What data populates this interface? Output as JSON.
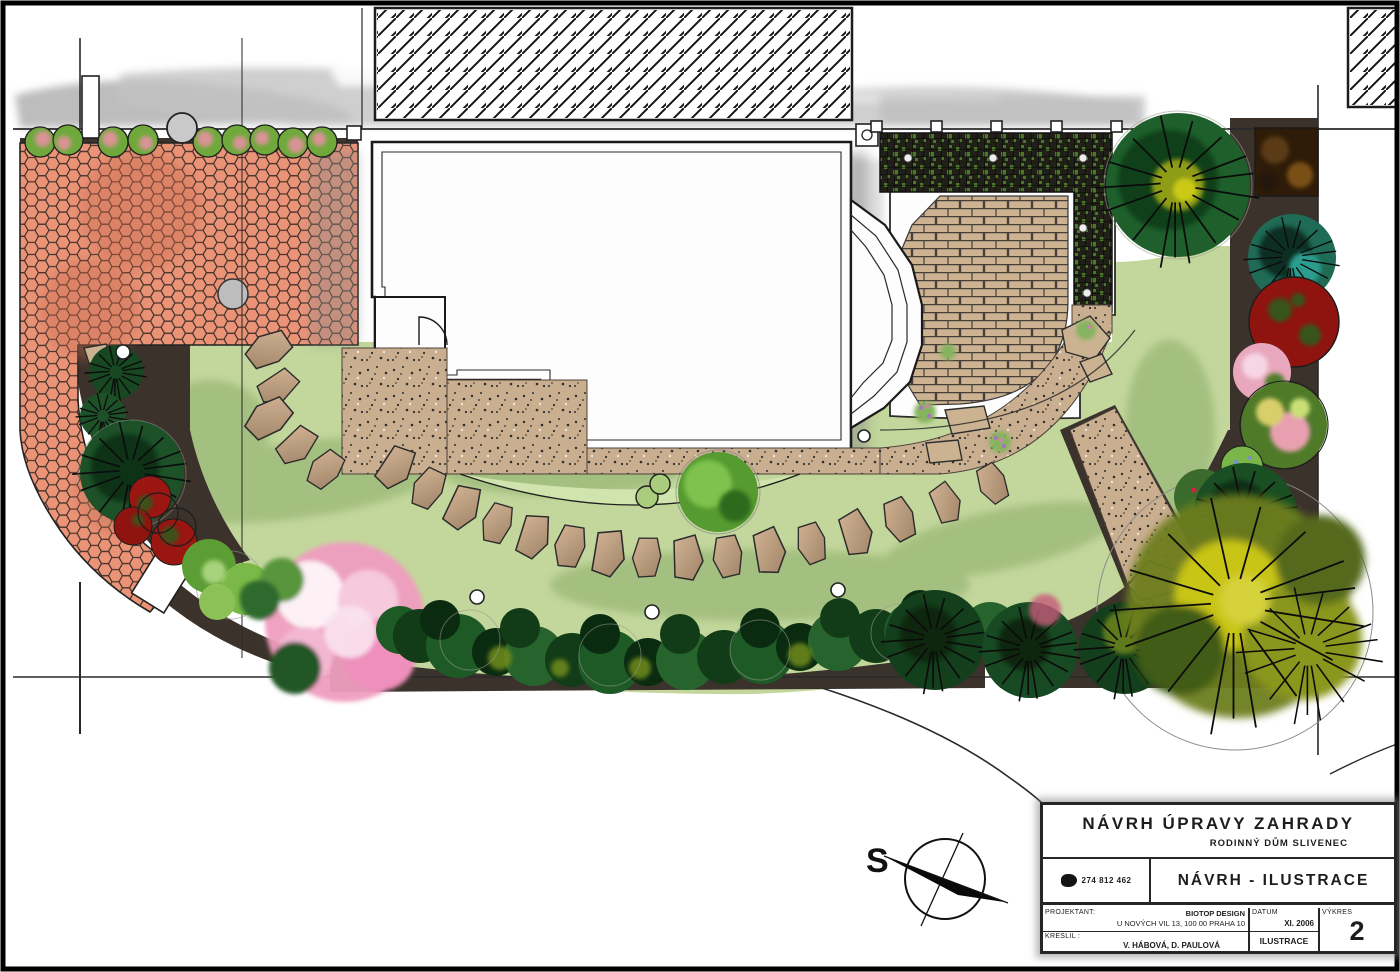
{
  "compass": {
    "label": "S"
  },
  "title_block": {
    "title": "NÁVRH ÚPRAVY ZAHRADY",
    "subtitle": "RODINNÝ DŮM SLIVENEC",
    "logo_phone": "274 812 462",
    "drawing_name": "NÁVRH - ILUSTRACE",
    "projektant_label": "PROJEKTANT:",
    "projektant_firm": "BIOTOP DESIGN",
    "projektant_address": "U NOVÝCH VIL 13, 100 00 PRAHA 10",
    "kreslil_label": "KRESLIL :",
    "kreslil_value": "V. HÁBOVÁ, D. PAULOVÁ",
    "datum_label": "DATUM",
    "datum_value": "XI. 2006",
    "category_value": "ILUSTRACE",
    "vykres_label": "VÝKRES",
    "vykres_value": "2"
  },
  "colors": {
    "lawn": "#c3d79c",
    "lawn_light": "#d2e4ad",
    "lawn_shadow": "#9ab877",
    "paving_salmon": "#ea9377",
    "gravel": "#c7ac8e",
    "pavers": "#cdb292",
    "bed_dark": "#3a322b",
    "hedge_dark": "#173f1d",
    "accent_pink": "#f0a9c7",
    "accent_red": "#9b1511",
    "accent_yellow": "#c9c513",
    "accent_teal": "#1f6b55"
  }
}
